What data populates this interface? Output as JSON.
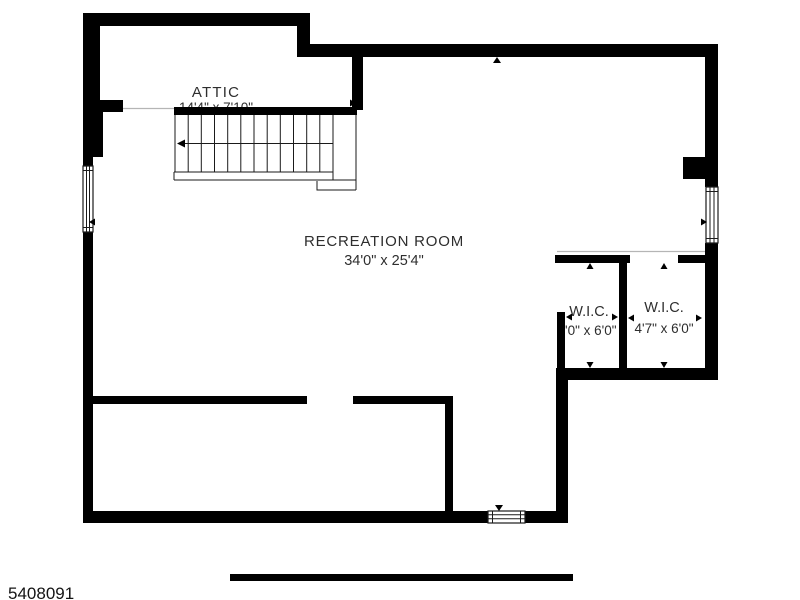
{
  "labels": {
    "attic": {
      "name": "ATTIC",
      "dims": "14'4\" x 7'10\""
    },
    "recreation": {
      "name": "RECREATION ROOM",
      "dims": "34'0\" x 25'4\""
    },
    "wic_left": {
      "name": "W.I.C.",
      "dims": "3'0\" x 6'0\""
    },
    "wic_right": {
      "name": "W.I.C.",
      "dims": "4'7\" x 6'0\""
    }
  },
  "footer": {
    "listing_id": "5408091"
  },
  "symbols": {
    "stair_direction_arrow": "left",
    "windows": [
      "window-left-wall",
      "window-right-wall",
      "window-bottom-wall"
    ],
    "dimension_arrow_count": 12
  },
  "colors": {
    "wall": "#000000",
    "background": "#ffffff",
    "label_text": "#2e2e2e",
    "ceiling_break_line": "#b5b5b5"
  }
}
